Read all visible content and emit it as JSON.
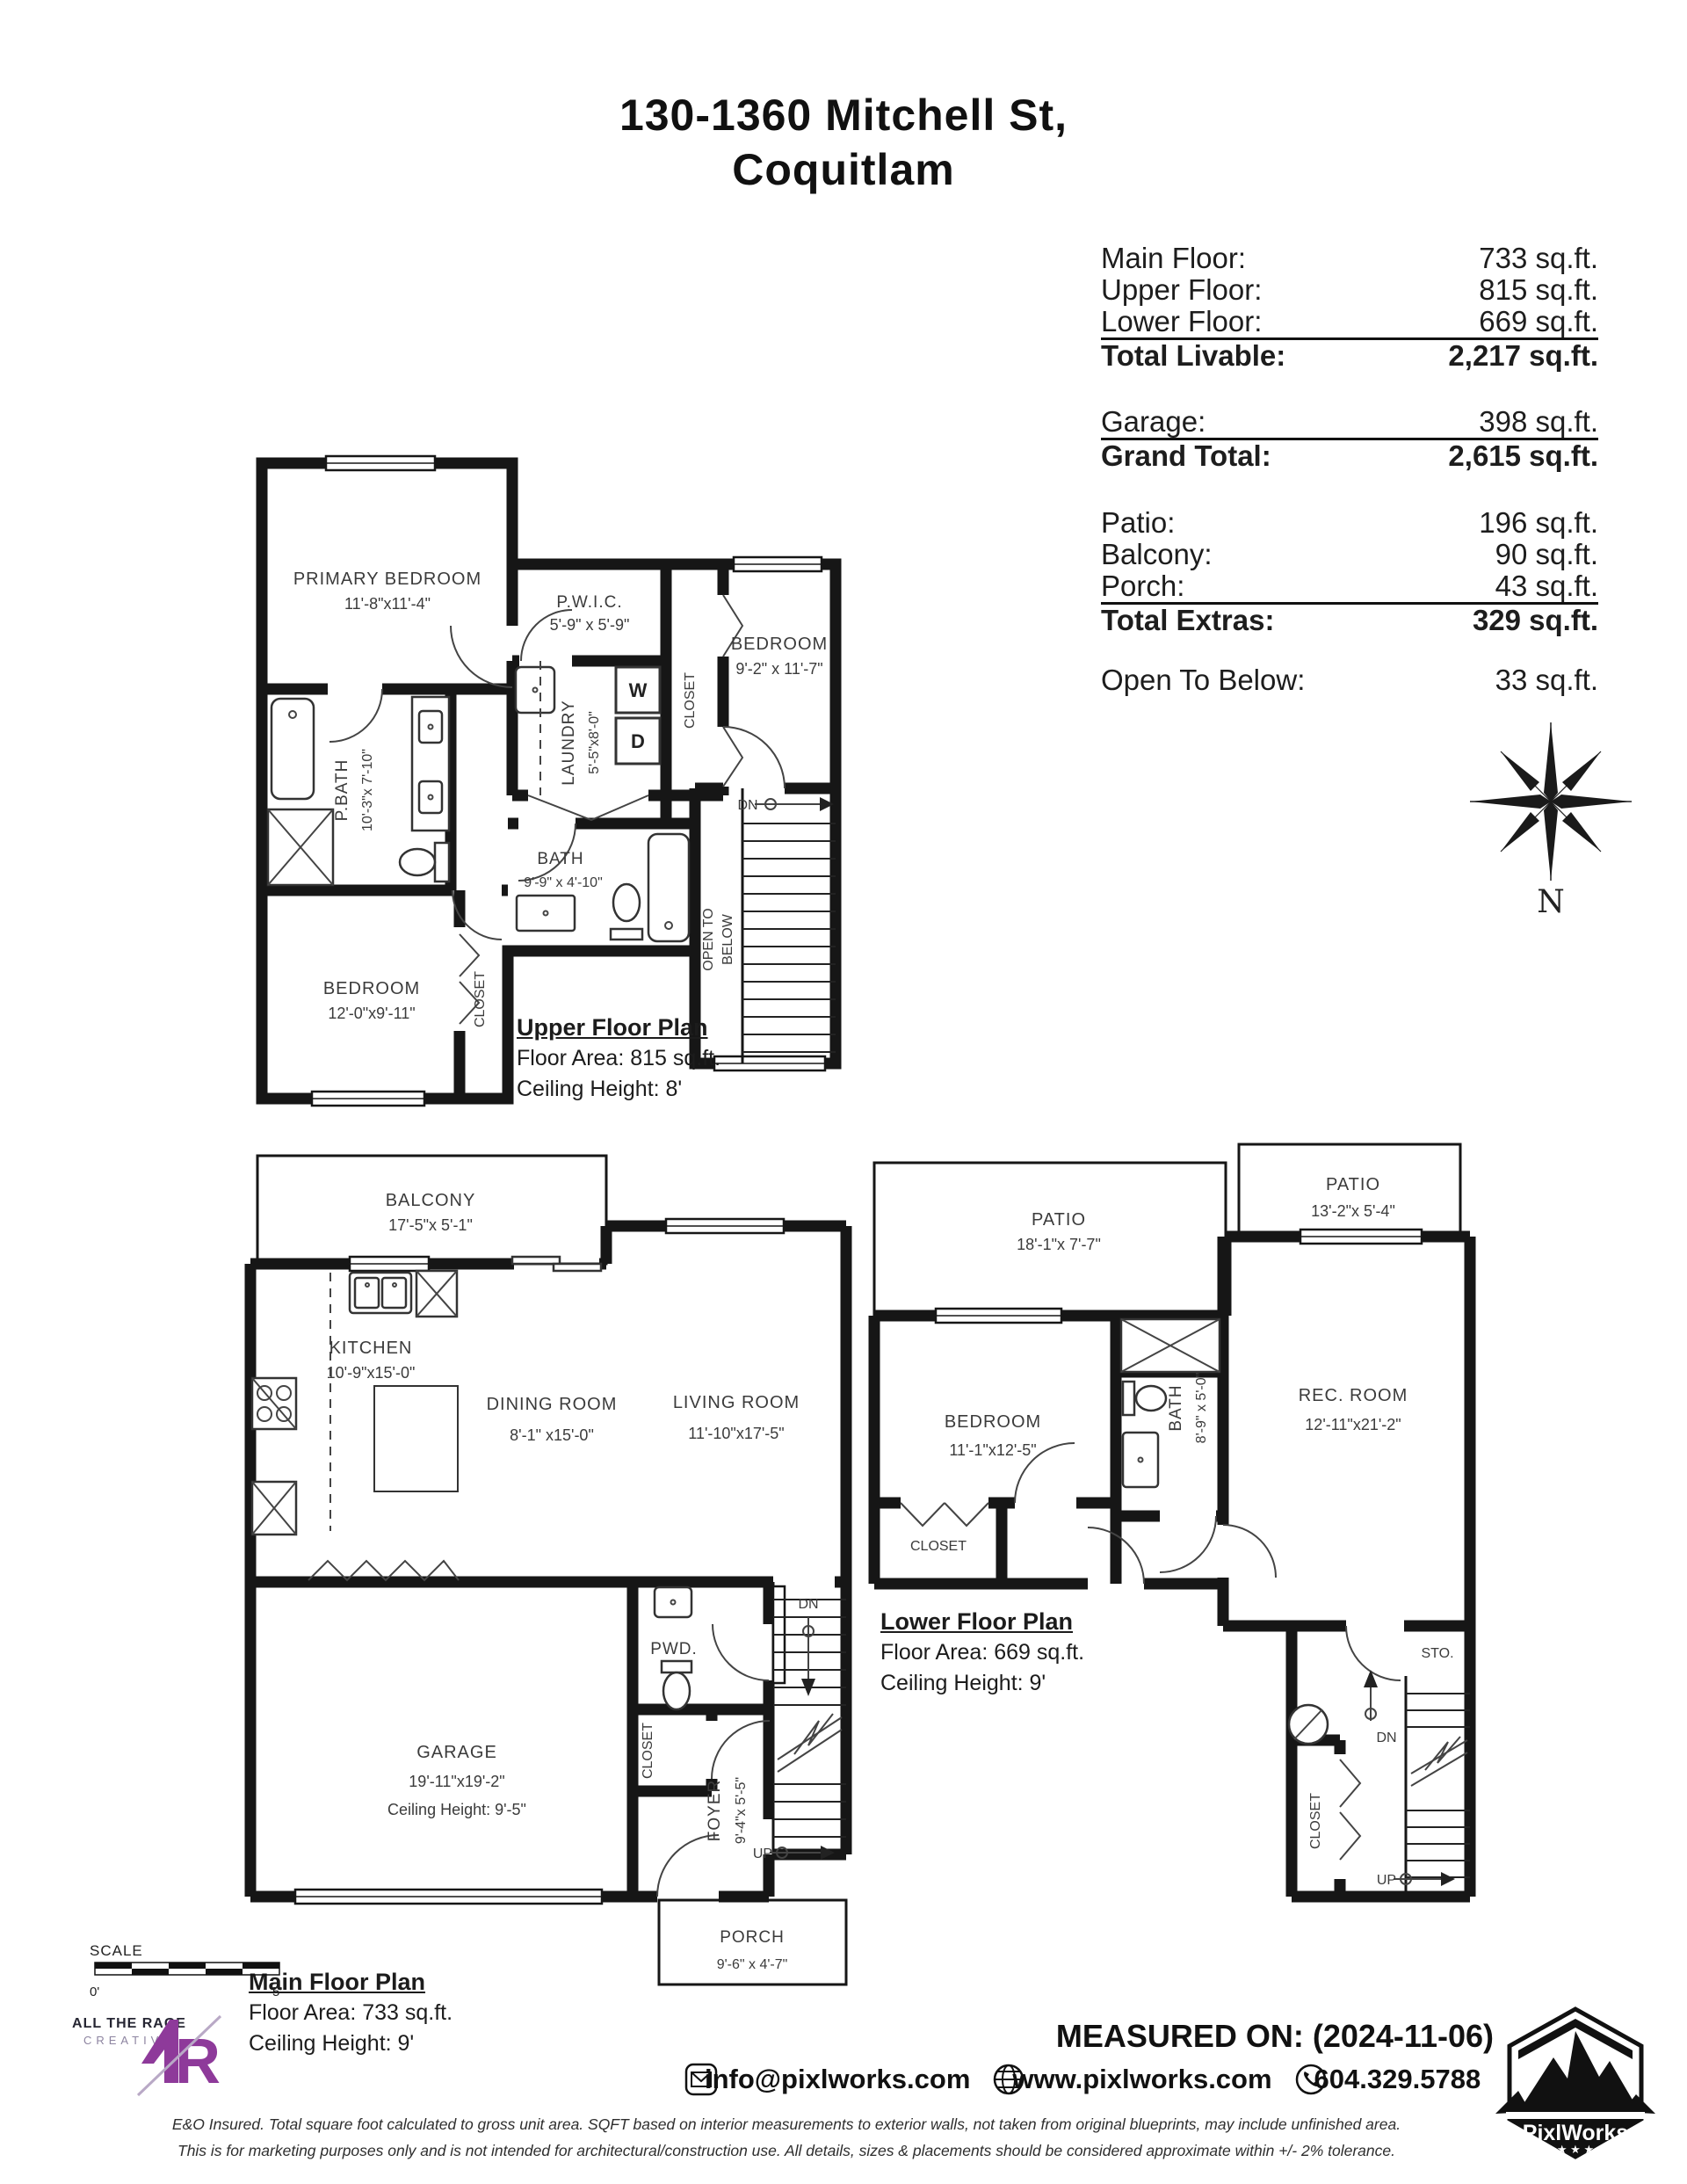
{
  "title": {
    "line1": "130-1360 Mitchell St,",
    "line2": "Coquitlam"
  },
  "area_table": {
    "rows": [
      {
        "label": "Main Floor:",
        "value": "733 sq.ft."
      },
      {
        "label": "Upper Floor:",
        "value": "815 sq.ft."
      },
      {
        "label": "Lower Floor:",
        "value": "669 sq.ft."
      },
      {
        "label": "Total Livable:",
        "value": "2,217 sq.ft."
      },
      {
        "label": "Garage:",
        "value": "398 sq.ft."
      },
      {
        "label": "Grand Total:",
        "value": "2,615 sq.ft."
      },
      {
        "label": "Patio:",
        "value": "196 sq.ft."
      },
      {
        "label": "Balcony:",
        "value": "90 sq.ft."
      },
      {
        "label": "Porch:",
        "value": "43 sq.ft."
      },
      {
        "label": "Total Extras:",
        "value": "329 sq.ft."
      },
      {
        "label": "Open To Below:",
        "value": "33 sq.ft."
      }
    ]
  },
  "compass": {
    "north_label": "N"
  },
  "upper_floor": {
    "title": "Upper Floor Plan",
    "floor_area": "Floor Area: 815 sq.ft.",
    "ceiling_height": "Ceiling Height: 8'",
    "rooms": {
      "primary_bedroom": {
        "label": "PRIMARY BEDROOM",
        "dims": "11'-8\"x11'-4\""
      },
      "pwic": {
        "label": "P.W.I.C.",
        "dims": "5'-9\" x 5'-9\""
      },
      "closet_bedroom2": "CLOSET",
      "bedroom2": {
        "label": "BEDROOM",
        "dims": "9'-2\" x 11'-7\""
      },
      "laundry": {
        "label": "LAUNDRY",
        "dims": "5'-5\"x8'-0\""
      },
      "washer": "W",
      "dryer": "D",
      "pbath": {
        "label": "P.BATH",
        "dims": "10'-3\"x 7'-10\""
      },
      "bath": {
        "label": "BATH",
        "dims": "9'-9\" x 4'-10\""
      },
      "bedroom3": {
        "label": "BEDROOM",
        "dims": "12'-0\"x9'-11\""
      },
      "closet_bedroom3": "CLOSET",
      "open_to_below_1": "OPEN TO",
      "open_to_below_2": "BELOW",
      "dn": "DN"
    }
  },
  "main_floor": {
    "title": "Main Floor Plan",
    "floor_area": "Floor Area: 733 sq.ft.",
    "ceiling_height": "Ceiling Height: 9'",
    "rooms": {
      "balcony": {
        "label": "BALCONY",
        "dims": "17'-5\"x 5'-1\""
      },
      "kitchen": {
        "label": "KITCHEN",
        "dims": "10'-9\"x15'-0\""
      },
      "dining": {
        "label": "DINING ROOM",
        "dims": "8'-1\" x15'-0\""
      },
      "living": {
        "label": "LIVING ROOM",
        "dims": "11'-10\"x17'-5\""
      },
      "garage": {
        "label": "GARAGE",
        "dims": "19'-11\"x19'-2\"",
        "ceiling": "Ceiling Height: 9'-5\""
      },
      "pwd": "PWD.",
      "closet": "CLOSET",
      "foyer": {
        "label": "FOYER",
        "dims": "9'-4\"x 5'-5\""
      },
      "porch": {
        "label": "PORCH",
        "dims": "9'-6\" x 4'-7\""
      },
      "dn": "DN",
      "up": "UP"
    }
  },
  "lower_floor": {
    "title": "Lower Floor Plan",
    "floor_area": "Floor Area: 669 sq.ft.",
    "ceiling_height": "Ceiling Height: 9'",
    "rooms": {
      "patio1": {
        "label": "PATIO",
        "dims": "18'-1\"x 7'-7\""
      },
      "patio2": {
        "label": "PATIO",
        "dims": "13'-2\"x 5'-4\""
      },
      "bedroom": {
        "label": "BEDROOM",
        "dims": "11'-1\"x12'-5\""
      },
      "bath": {
        "label": "BATH",
        "dims": "8'-9\" x 5'-0\""
      },
      "rec_room": {
        "label": "REC. ROOM",
        "dims": "12'-11\"x21'-2\""
      },
      "closet1": "CLOSET",
      "closet2": "CLOSET",
      "storage": "STO.",
      "dn": "DN",
      "up": "UP"
    }
  },
  "scale_bar": {
    "label": "SCALE",
    "start": "0'",
    "end": "5'"
  },
  "branding": {
    "atr": {
      "name": "ALL THE RAGE",
      "sub": "CREATIVE",
      "accent_color": "#8e3a9a"
    },
    "pixlworks": {
      "name": "PixlWorks"
    }
  },
  "footer": {
    "measured_on": "MEASURED ON: (2024-11-06)",
    "email": "info@pixlworks.com",
    "website": "www.pixlworks.com",
    "phone": "604.329.5788",
    "disclaimer_line1": "E&O Insured.  Total square foot calculated to gross unit area. SQFT based on interior measurements to exterior walls, not taken from original blueprints, may include unfinished area.",
    "disclaimer_line2": "This is for marketing purposes only and is not intended for architectural/construction use.  All details, sizes & placements should be considered approximate within +/- 2%  tolerance."
  },
  "icons": {
    "email": "envelope-icon",
    "website": "globe-icon",
    "phone": "phone-icon",
    "compass": "compass-rose-icon"
  }
}
